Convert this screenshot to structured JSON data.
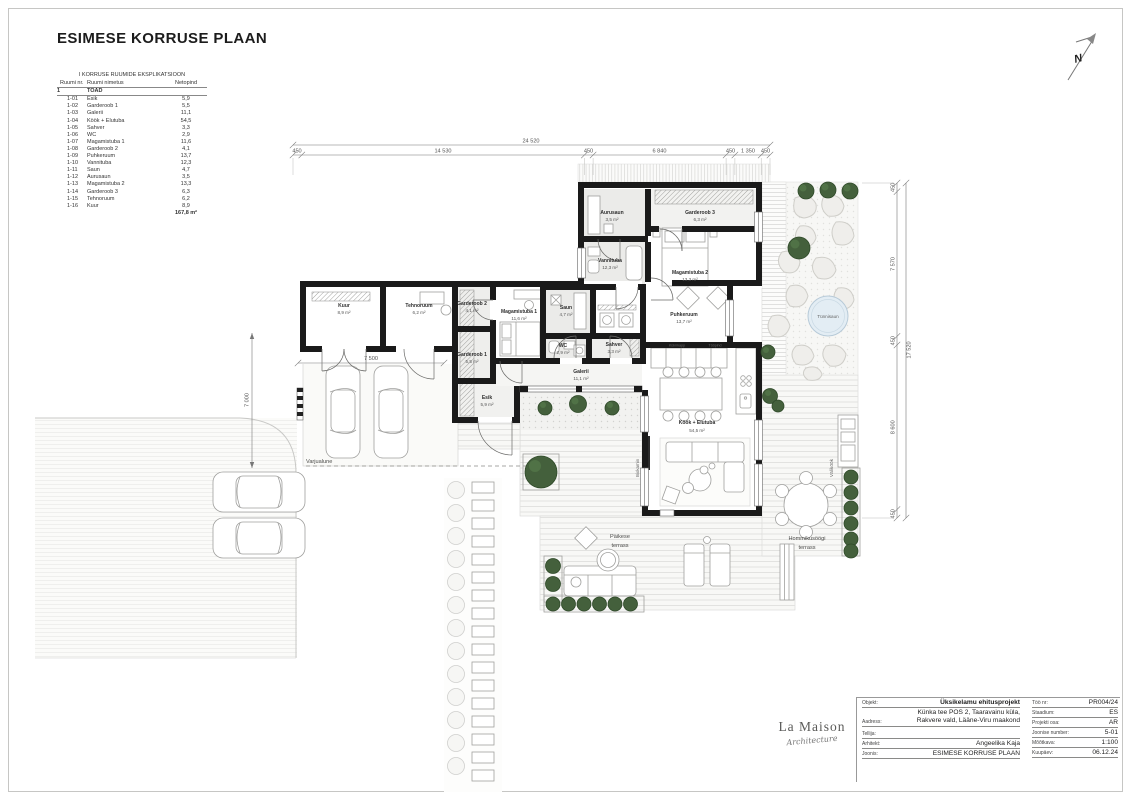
{
  "sheet": {
    "title": "ESIMESE KORRUSE PLAAN",
    "north_label": "N"
  },
  "schedule": {
    "title": "I KORRUSE RUUMIDE EKSPLIKATSIOON",
    "columns": {
      "nr": "Ruumi nr.",
      "name": "Ruumi nimetus",
      "area": "Netopind"
    },
    "group": {
      "nr": "1",
      "label": "TOAD"
    },
    "rows": [
      {
        "nr": "1-01",
        "name": "Esik",
        "area": "5,9"
      },
      {
        "nr": "1-02",
        "name": "Garderoob 1",
        "area": "5,5"
      },
      {
        "nr": "1-03",
        "name": "Galerii",
        "area": "11,1"
      },
      {
        "nr": "1-04",
        "name": "Köök + Elutuba",
        "area": "54,5"
      },
      {
        "nr": "1-05",
        "name": "Sahver",
        "area": "3,3"
      },
      {
        "nr": "1-06",
        "name": "WC",
        "area": "2,9"
      },
      {
        "nr": "1-07",
        "name": "Magamistuba 1",
        "area": "11,6"
      },
      {
        "nr": "1-08",
        "name": "Garderoob 2",
        "area": "4,1"
      },
      {
        "nr": "1-09",
        "name": "Puhkeruum",
        "area": "13,7"
      },
      {
        "nr": "1-10",
        "name": "Vannituba",
        "area": "12,3"
      },
      {
        "nr": "1-11",
        "name": "Saun",
        "area": "4,7"
      },
      {
        "nr": "1-12",
        "name": "Aurusaun",
        "area": "3,5"
      },
      {
        "nr": "1-13",
        "name": "Magamistuba 2",
        "area": "13,3"
      },
      {
        "nr": "1-14",
        "name": "Garderoob 3",
        "area": "6,3"
      },
      {
        "nr": "1-15",
        "name": "Tehnoruum",
        "area": "6,2"
      },
      {
        "nr": "1-16",
        "name": "Kuur",
        "area": "8,9"
      }
    ],
    "total": "167,8 m²"
  },
  "plan": {
    "rooms": [
      {
        "name": "Aurusaun",
        "area": "3,5 m²"
      },
      {
        "name": "Garderoob 3",
        "area": "6,3 m²"
      },
      {
        "name": "Vannituba",
        "area": "12,3 m²"
      },
      {
        "name": "Magamistuba 2",
        "area": "13,3 m²"
      },
      {
        "name": "Puhkeruum",
        "area": "13,7 m²"
      },
      {
        "name": "Kuur",
        "area": "8,9 m²"
      },
      {
        "name": "Tehnoruum",
        "area": "6,2 m²"
      },
      {
        "name": "Garderoob 2",
        "area": "4,1 m²"
      },
      {
        "name": "Magamistuba 1",
        "area": "11,6 m²"
      },
      {
        "name": "Saun",
        "area": "4,7 m²"
      },
      {
        "name": "WC",
        "area": "2,9 m²"
      },
      {
        "name": "Sahver",
        "area": "3,3 m²"
      },
      {
        "name": "Garderoob 1",
        "area": "5,5 m²"
      },
      {
        "name": "Esik",
        "area": "5,9 m²"
      },
      {
        "name": "Galerii",
        "area": "11,1 m²"
      },
      {
        "name": "Köök + Elutuba",
        "area": "54,5 m²"
      }
    ],
    "labels": {
      "varjualune": "Varjualune",
      "tunnisaun": "Tünnisaun",
      "valikook": "Väliköök",
      "biokamin": "Biokamin",
      "paikese1": "Päikese",
      "paikese2": "terrass",
      "hommikusoogi1": "Hommikusöögi",
      "hommikusoogi2": "terrass",
      "kulmkapp": "Külmkapp",
      "toopind": "Tööpind"
    },
    "dimensions": {
      "top_total": "24 520",
      "top_segments": [
        "450",
        "14 530",
        "450",
        "6 840",
        "450",
        "1 350",
        "450"
      ],
      "right_total": "17 520",
      "right_segments": [
        "450",
        "7 570",
        "450",
        "8 600",
        "450"
      ],
      "left_height": "7 000",
      "carport_width": "7 500"
    }
  },
  "titleblock": {
    "logo_line1": "La Maison",
    "logo_line2": "Architecture",
    "objekt_label": "Objekt:",
    "objekt_value": "Üksikelamu ehitusprojekt",
    "aadress_label": "Aadress:",
    "aadress_value1": "Künka tee POS 2, Taaravainu küla,",
    "aadress_value2": "Rakvere vald, Lääne-Viru maakond",
    "tellija_label": "Tellija:",
    "tellija_value": "",
    "arhitekt_label": "Arhitekt:",
    "arhitekt_value": "Angeelika Kaja",
    "joonis_label": "Joonis:",
    "joonis_value": "ESIMESE KORRUSE PLAAN",
    "toonr_label": "Töö nr:",
    "toonr_value": "PR004/24",
    "staadium_label": "Staadium:",
    "staadium_value": "ES",
    "projektiosa_label": "Projekti osa:",
    "projektiosa_value": "AR",
    "joonisenumber_label": "Joonise number:",
    "joonisenumber_value": "5-01",
    "mootkava_label": "Mõõtkava:",
    "mootkava_value": "1:100",
    "kuupaev_label": "Kuupäev:",
    "kuupaev_value": "06.12.24"
  }
}
